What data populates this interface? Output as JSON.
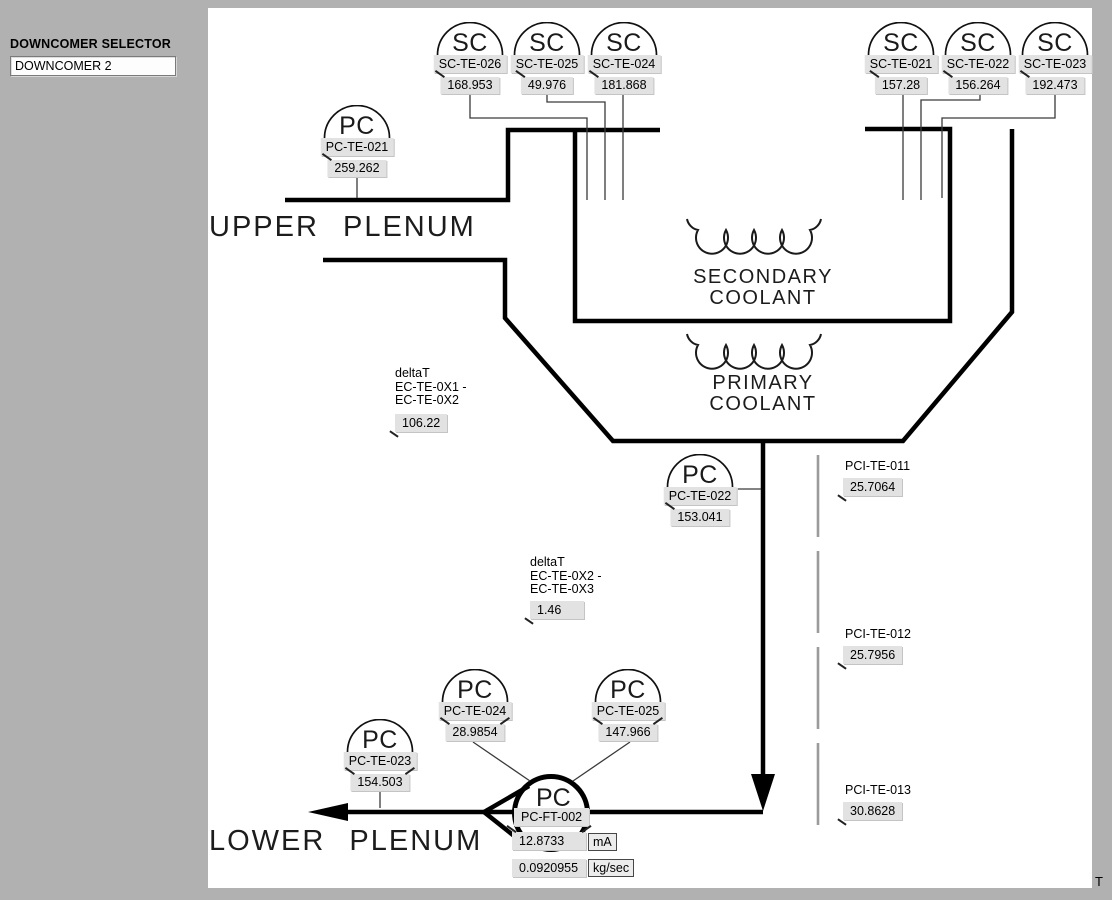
{
  "selector": {
    "label": "DOWNCOMER SELECTOR",
    "value": "DOWNCOMER 2"
  },
  "diagram": {
    "texts": {
      "upper_plenum": "UPPER PLENUM",
      "lower_plenum": "LOWER PLENUM",
      "secondary_coolant_line1": "SECONDARY",
      "secondary_coolant_line2": "COOLANT",
      "primary_coolant_line1": "PRIMARY",
      "primary_coolant_line2": "COOLANT"
    },
    "sensors": [
      {
        "symbol": "SC",
        "tag": "SC-TE-026",
        "value": "168.953"
      },
      {
        "symbol": "SC",
        "tag": "SC-TE-025",
        "value": "49.976"
      },
      {
        "symbol": "SC",
        "tag": "SC-TE-024",
        "value": "181.868"
      },
      {
        "symbol": "SC",
        "tag": "SC-TE-021",
        "value": "157.28"
      },
      {
        "symbol": "SC",
        "tag": "SC-TE-022",
        "value": "156.264"
      },
      {
        "symbol": "SC",
        "tag": "SC-TE-023",
        "value": "192.473"
      },
      {
        "symbol": "PC",
        "tag": "PC-TE-021",
        "value": "259.262"
      },
      {
        "symbol": "PC",
        "tag": "PC-TE-022",
        "value": "153.041"
      },
      {
        "symbol": "PC",
        "tag": "PC-TE-023",
        "value": "154.503"
      },
      {
        "symbol": "PC",
        "tag": "PC-TE-024",
        "value": "28.9854"
      },
      {
        "symbol": "PC",
        "tag": "PC-TE-025",
        "value": "147.966"
      }
    ],
    "flow_meter": {
      "symbol": "PC",
      "tag": "PC-FT-002",
      "current_value": "12.8733",
      "current_unit": "mA",
      "flow_value": "0.0920955",
      "flow_unit": "kg/sec"
    },
    "delta_t": [
      {
        "line1": "deltaT",
        "line2": "EC-TE-0X1 -",
        "line3": "EC-TE-0X2",
        "value": "106.22"
      },
      {
        "line1": "deltaT",
        "line2": "EC-TE-0X2 -",
        "line3": "EC-TE-0X3",
        "value": "1.46"
      }
    ],
    "pci_sensors": [
      {
        "tag": "PCI-TE-011",
        "value": "25.7064"
      },
      {
        "tag": "PCI-TE-012",
        "value": "25.7956"
      },
      {
        "tag": "PCI-TE-013",
        "value": "30.8628"
      }
    ]
  },
  "corner_text": "T"
}
